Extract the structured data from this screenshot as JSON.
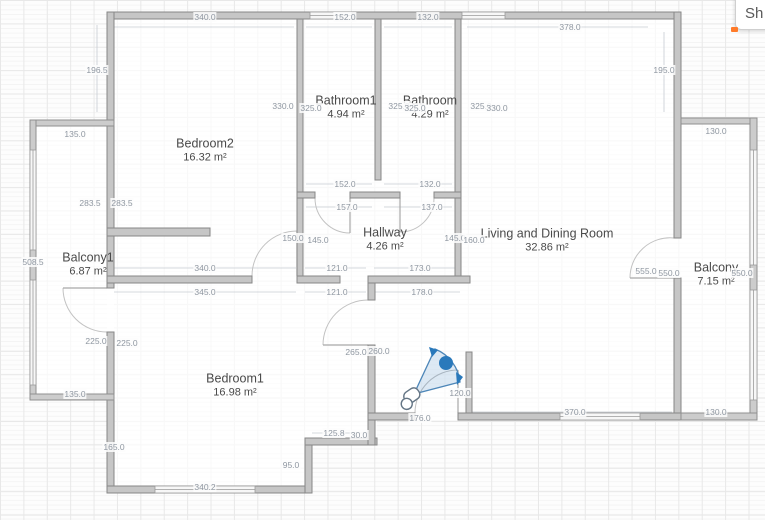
{
  "app": {
    "share_button_label": "Sh"
  },
  "floorplan": {
    "rooms": [
      {
        "name": "Bedroom2",
        "area": "16.32 m²",
        "x": 205,
        "y": 150
      },
      {
        "name": "Bathroom1",
        "area": "4.94 m²",
        "x": 346,
        "y": 107
      },
      {
        "name": "Bathroom",
        "area": "4.29 m²",
        "x": 430,
        "y": 107
      },
      {
        "name": "Living and Dining Room",
        "area": "32.86 m²",
        "x": 547,
        "y": 240
      },
      {
        "name": "Hallway",
        "area": "4.26 m²",
        "x": 385,
        "y": 239
      },
      {
        "name": "Balcony1",
        "area": "6.87 m²",
        "x": 88,
        "y": 264
      },
      {
        "name": "Balcony",
        "area": "7.15 m²",
        "x": 716,
        "y": 274
      },
      {
        "name": "Bedroom1",
        "area": "16.98 m²",
        "x": 235,
        "y": 385
      }
    ],
    "dimensions": [
      {
        "value": "340.0",
        "x": 205,
        "y": 17
      },
      {
        "value": "152.0",
        "x": 345,
        "y": 17
      },
      {
        "value": "132.0",
        "x": 428,
        "y": 17
      },
      {
        "value": "378.0",
        "x": 570,
        "y": 27
      },
      {
        "value": "196.5",
        "x": 97,
        "y": 70
      },
      {
        "value": "195.0",
        "x": 664,
        "y": 70
      },
      {
        "value": "330.0",
        "x": 283,
        "y": 106
      },
      {
        "value": "325.0",
        "x": 311,
        "y": 108
      },
      {
        "value": "325.0",
        "x": 399,
        "y": 106
      },
      {
        "value": "325.0",
        "x": 415,
        "y": 108
      },
      {
        "value": "325.0",
        "x": 481,
        "y": 106
      },
      {
        "value": "330.0",
        "x": 497,
        "y": 108
      },
      {
        "value": "135.0",
        "x": 75,
        "y": 134
      },
      {
        "value": "130.0",
        "x": 716,
        "y": 131
      },
      {
        "value": "152.0",
        "x": 345,
        "y": 184
      },
      {
        "value": "132.0",
        "x": 430,
        "y": 184
      },
      {
        "value": "157.0",
        "x": 347,
        "y": 207
      },
      {
        "value": "137.0",
        "x": 432,
        "y": 207
      },
      {
        "value": "283.5",
        "x": 90,
        "y": 203
      },
      {
        "value": "283.5",
        "x": 122,
        "y": 203
      },
      {
        "value": "150.0",
        "x": 293,
        "y": 238
      },
      {
        "value": "145.0",
        "x": 318,
        "y": 240
      },
      {
        "value": "145.0",
        "x": 455,
        "y": 238
      },
      {
        "value": "160.0",
        "x": 474,
        "y": 240
      },
      {
        "value": "508.5",
        "x": 33,
        "y": 262
      },
      {
        "value": "340.0",
        "x": 205,
        "y": 268
      },
      {
        "value": "121.0",
        "x": 337,
        "y": 268
      },
      {
        "value": "173.0",
        "x": 420,
        "y": 268
      },
      {
        "value": "555.0",
        "x": 646,
        "y": 271
      },
      {
        "value": "550.0",
        "x": 669,
        "y": 273
      },
      {
        "value": "550.0",
        "x": 742,
        "y": 273
      },
      {
        "value": "345.0",
        "x": 205,
        "y": 292
      },
      {
        "value": "121.0",
        "x": 337,
        "y": 292
      },
      {
        "value": "178.0",
        "x": 422,
        "y": 292
      },
      {
        "value": "225.0",
        "x": 96,
        "y": 341
      },
      {
        "value": "225.0",
        "x": 127,
        "y": 343
      },
      {
        "value": "265.0",
        "x": 356,
        "y": 352
      },
      {
        "value": "260.0",
        "x": 379,
        "y": 351
      },
      {
        "value": "120.0",
        "x": 460,
        "y": 393
      },
      {
        "value": "135.0",
        "x": 75,
        "y": 394
      },
      {
        "value": "370.0",
        "x": 575,
        "y": 412
      },
      {
        "value": "130.0",
        "x": 716,
        "y": 412
      },
      {
        "value": "176.0",
        "x": 420,
        "y": 418
      },
      {
        "value": "125.8",
        "x": 334,
        "y": 433
      },
      {
        "value": "30.0",
        "x": 359,
        "y": 435
      },
      {
        "value": "165.0",
        "x": 114,
        "y": 447
      },
      {
        "value": "95.0",
        "x": 291,
        "y": 465
      },
      {
        "value": "340.2",
        "x": 205,
        "y": 487
      }
    ],
    "colors": {
      "wall_fill": "#c6c6c6",
      "wall_stroke": "#878787",
      "dimension_text": "#8f97a1",
      "room_text": "#4a4a4a",
      "camera_blue": "#2a79bb",
      "accent_orange": "#ff7b2a"
    }
  }
}
